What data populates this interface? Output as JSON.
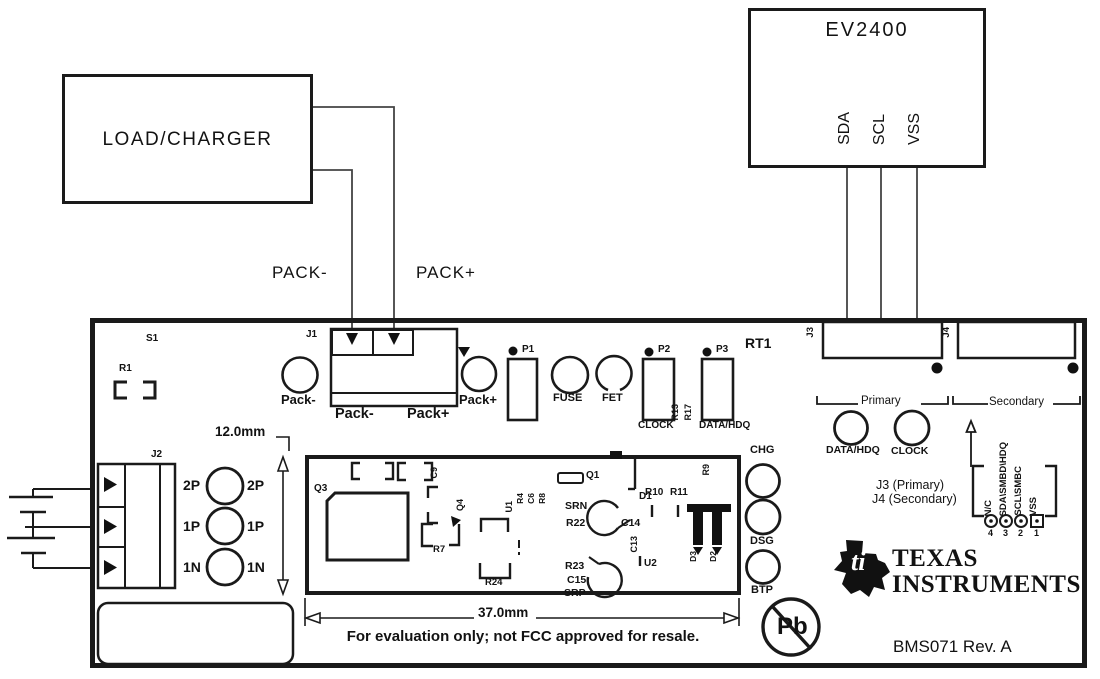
{
  "external": {
    "load_charger": "LOAD/CHARGER",
    "ev2400": "EV2400",
    "ev2400_pins": [
      "SDA",
      "SCL",
      "VSS"
    ],
    "pack_minus_wire": "PACK-",
    "pack_plus_wire": "PACK+"
  },
  "board": {
    "silkscreen": {
      "s1": "S1",
      "r1": "R1",
      "j1": "J1",
      "j2": "J2",
      "rt1": "RT1",
      "pack_minus_pad": "Pack-",
      "pack_plus_pad": "Pack+",
      "j1_pack_minus": "Pack-",
      "j1_pack_plus": "Pack+",
      "p1": "P1",
      "p2": "P2",
      "p3": "P3",
      "fuse": "FUSE",
      "fet": "FET",
      "clock": "CLOCK",
      "data_hdq": "DATA/HDQ",
      "r13": "R13",
      "r17": "R17"
    },
    "j2_rows_left": [
      "2P",
      "1P",
      "1N"
    ],
    "j2_rows_right": [
      "2P",
      "1P",
      "1N"
    ],
    "comm": {
      "j3": "J3",
      "j4": "J4",
      "primary": "Primary",
      "secondary": "Secondary",
      "data_hdq_led": "DATA/HDQ",
      "clock_led": "CLOCK",
      "j3_primary": "J3 (Primary)",
      "j4_secondary": "J4 (Secondary)",
      "pins": [
        "N/C",
        "SDA\\SMBD\\HDQ",
        "SCL\\SMBC",
        "VSS"
      ],
      "pin_numbers": [
        "4",
        "3",
        "2",
        "1"
      ]
    },
    "module": {
      "q3": "Q3",
      "c9": "C9",
      "q4": "Q4",
      "r7": "R7",
      "u1": "U1",
      "r4": "R4",
      "c6": "C6",
      "r8": "R8",
      "q1": "Q1",
      "srn": "SRN",
      "r22": "R22",
      "c14": "C14",
      "d1": "D1",
      "r10": "R10",
      "r11": "R11",
      "c13": "C13",
      "u2": "U2",
      "r23": "R23",
      "c15": "C15",
      "srp": "SRP",
      "r24": "R24",
      "d3": "D3",
      "d2": "D2",
      "r9": "R9"
    },
    "leds": [
      "CHG",
      "DSG",
      "BTP"
    ],
    "dim_height": "12.0mm",
    "dim_width": "37.0mm",
    "eval_note": "For evaluation only; not FCC approved for resale.",
    "brand": {
      "ti_bug": "ti",
      "line1": "TEXAS",
      "line2": "INSTRUMENTS",
      "board_id": "BMS071 Rev. A",
      "pb": "Pb"
    }
  }
}
